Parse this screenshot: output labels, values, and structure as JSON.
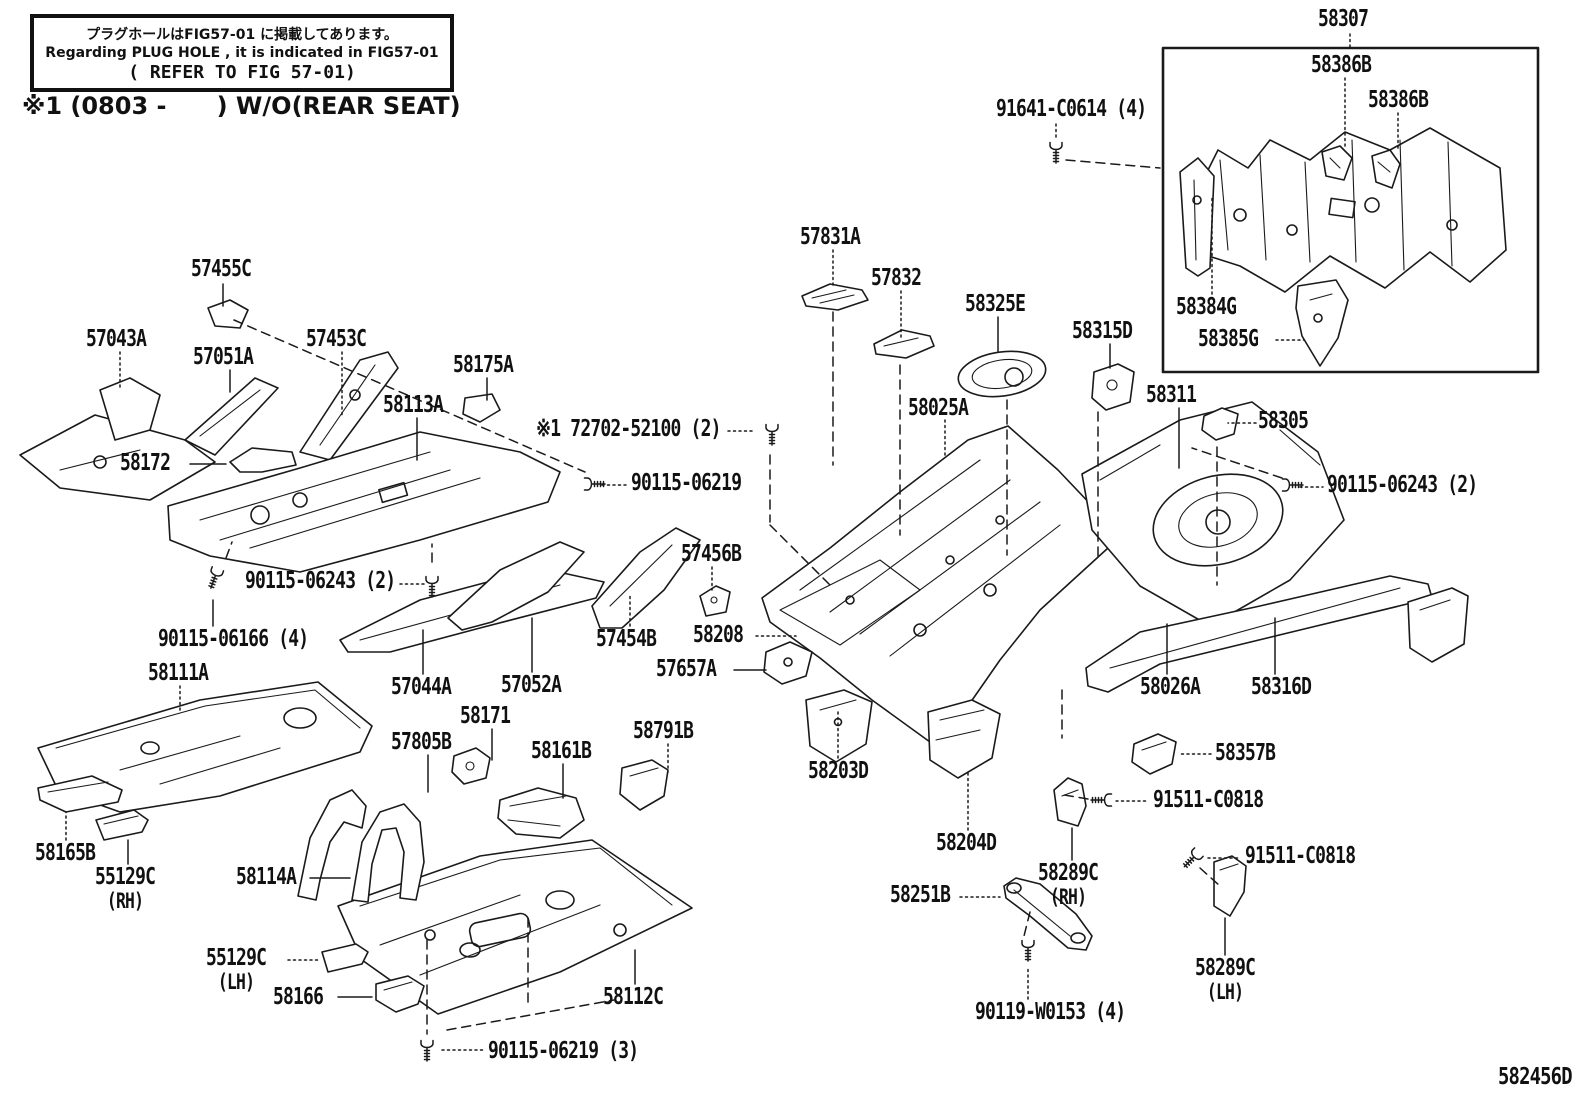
{
  "page": {
    "background": "#ffffff",
    "line_color": "#1a1a1a"
  },
  "note_box": {
    "line1": "プラグホールはFIG57-01 に掲載してあります。",
    "line2": "Regarding PLUG HOLE , it is indicated in FIG57-01",
    "line3": "( REFER TO FIG 57-01)"
  },
  "footnote": "※1 (0803 -      ) W/O(REAR SEAT)",
  "figure_code": "582456D",
  "diagram": {
    "labels": [
      {
        "text": "58307",
        "x": 1318,
        "y": 8,
        "leaders": [
          [
            1350,
            34,
            1350,
            47,
            "dotted"
          ]
        ]
      },
      {
        "text": "58386B",
        "x": 1311,
        "y": 54,
        "leaders": [
          [
            1345,
            78,
            1345,
            146,
            "dotted"
          ]
        ]
      },
      {
        "text": "58386B",
        "x": 1368,
        "y": 89,
        "leaders": [
          [
            1398,
            113,
            1398,
            150,
            "dotted"
          ]
        ]
      },
      {
        "text": "91641-C0614 (4)",
        "x": 996,
        "y": 98,
        "leaders": [
          [
            1056,
            124,
            1056,
            138,
            "dotted"
          ]
        ]
      },
      {
        "text": "58384G",
        "x": 1176,
        "y": 296,
        "leaders": [
          [
            1212,
            294,
            1212,
            198,
            "dotted"
          ]
        ]
      },
      {
        "text": "58385G",
        "x": 1198,
        "y": 328,
        "leaders": [
          [
            1276,
            340,
            1304,
            340,
            "dotted"
          ]
        ]
      },
      {
        "text": "57455C",
        "x": 191,
        "y": 258,
        "leaders": [
          [
            223,
            284,
            223,
            306,
            "solid"
          ]
        ]
      },
      {
        "text": "57043A",
        "x": 86,
        "y": 328,
        "leaders": [
          [
            120,
            352,
            120,
            388,
            "dotted"
          ]
        ]
      },
      {
        "text": "57051A",
        "x": 193,
        "y": 346,
        "leaders": [
          [
            230,
            370,
            230,
            392,
            "solid"
          ]
        ]
      },
      {
        "text": "57453C",
        "x": 306,
        "y": 328,
        "leaders": [
          [
            342,
            352,
            342,
            415,
            "dotted"
          ]
        ]
      },
      {
        "text": "58175A",
        "x": 453,
        "y": 354,
        "leaders": [
          [
            487,
            378,
            487,
            400,
            "solid"
          ]
        ]
      },
      {
        "text": "58113A",
        "x": 383,
        "y": 394,
        "leaders": [
          [
            417,
            418,
            417,
            460,
            "solid"
          ]
        ]
      },
      {
        "text": "58172",
        "x": 120,
        "y": 452,
        "leaders": [
          [
            190,
            464,
            226,
            464,
            "solid"
          ]
        ]
      },
      {
        "text": "※1 72702-52100 (2)",
        "x": 536,
        "y": 418,
        "leaders": [
          [
            728,
            431,
            752,
            431,
            "dotted"
          ]
        ]
      },
      {
        "text": "90115-06219",
        "x": 631,
        "y": 472,
        "leaders": [
          [
            602,
            485,
            627,
            485,
            "dotted"
          ]
        ]
      },
      {
        "text": "58025A",
        "x": 908,
        "y": 397,
        "leaders": [
          [
            945,
            420,
            945,
            458,
            "dotted"
          ]
        ]
      },
      {
        "text": "57831A",
        "x": 800,
        "y": 226,
        "leaders": [
          [
            833,
            250,
            833,
            286,
            "dotted"
          ]
        ]
      },
      {
        "text": "57832",
        "x": 871,
        "y": 267,
        "leaders": [
          [
            901,
            291,
            901,
            340,
            "dotted"
          ]
        ]
      },
      {
        "text": "58325E",
        "x": 965,
        "y": 293,
        "leaders": [
          [
            998,
            317,
            998,
            352,
            "solid"
          ]
        ]
      },
      {
        "text": "58315D",
        "x": 1072,
        "y": 320,
        "leaders": [
          [
            1110,
            344,
            1110,
            368,
            "solid"
          ]
        ]
      },
      {
        "text": "58311",
        "x": 1146,
        "y": 384,
        "leaders": [
          [
            1179,
            408,
            1179,
            468,
            "solid"
          ]
        ]
      },
      {
        "text": "58305",
        "x": 1258,
        "y": 410,
        "leaders": [
          [
            1256,
            423,
            1228,
            423,
            "dotted"
          ]
        ]
      },
      {
        "text": "90115-06243 (2)",
        "x": 1327,
        "y": 474,
        "leaders": [
          [
            1300,
            487,
            1323,
            487,
            "dotted"
          ]
        ]
      },
      {
        "text": "90115-06243 (2)",
        "x": 245,
        "y": 570,
        "leaders": [
          [
            400,
            584,
            424,
            584,
            "dotted"
          ]
        ]
      },
      {
        "text": "90115-06166 (4)",
        "x": 158,
        "y": 628,
        "leaders": [
          [
            213,
            626,
            213,
            600,
            "solid"
          ]
        ]
      },
      {
        "text": "57456B",
        "x": 681,
        "y": 543,
        "leaders": [
          [
            712,
            567,
            712,
            590,
            "dotted"
          ]
        ]
      },
      {
        "text": "57454B",
        "x": 596,
        "y": 628,
        "leaders": [
          [
            630,
            626,
            630,
            594,
            "dotted"
          ]
        ]
      },
      {
        "text": "58208",
        "x": 693,
        "y": 624,
        "leaders": [
          [
            756,
            636,
            796,
            636,
            "dotted"
          ]
        ]
      },
      {
        "text": "57657A",
        "x": 656,
        "y": 658,
        "leaders": [
          [
            734,
            670,
            766,
            670,
            "solid"
          ]
        ]
      },
      {
        "text": "58111A",
        "x": 148,
        "y": 662,
        "leaders": [
          [
            180,
            686,
            180,
            712,
            "dotted"
          ]
        ]
      },
      {
        "text": "57044A",
        "x": 391,
        "y": 676,
        "leaders": [
          [
            423,
            674,
            423,
            630,
            "solid"
          ]
        ]
      },
      {
        "text": "57052A",
        "x": 501,
        "y": 674,
        "leaders": [
          [
            532,
            672,
            532,
            618,
            "solid"
          ]
        ]
      },
      {
        "text": "58171",
        "x": 460,
        "y": 705,
        "leaders": [
          [
            492,
            729,
            492,
            760,
            "solid"
          ]
        ]
      },
      {
        "text": "57805B",
        "x": 391,
        "y": 731,
        "leaders": [
          [
            428,
            755,
            428,
            792,
            "solid"
          ]
        ]
      },
      {
        "text": "58161B",
        "x": 531,
        "y": 740,
        "leaders": [
          [
            563,
            764,
            563,
            798,
            "solid"
          ]
        ]
      },
      {
        "text": "58791B",
        "x": 633,
        "y": 720,
        "leaders": [
          [
            668,
            744,
            668,
            772,
            "dotted"
          ]
        ]
      },
      {
        "text": "58203D",
        "x": 808,
        "y": 760,
        "leaders": [
          [
            838,
            758,
            838,
            712,
            "dotted"
          ]
        ]
      },
      {
        "text": "58204D",
        "x": 936,
        "y": 832,
        "leaders": [
          [
            968,
            830,
            968,
            772,
            "dotted"
          ]
        ]
      },
      {
        "text": "58026A",
        "x": 1140,
        "y": 676,
        "leaders": [
          [
            1167,
            674,
            1167,
            624,
            "solid"
          ]
        ]
      },
      {
        "text": "58316D",
        "x": 1251,
        "y": 676,
        "leaders": [
          [
            1275,
            674,
            1275,
            618,
            "solid"
          ]
        ]
      },
      {
        "text": "58357B",
        "x": 1215,
        "y": 742,
        "leaders": [
          [
            1211,
            754,
            1180,
            754,
            "dotted"
          ]
        ]
      },
      {
        "text": "91511-C0818",
        "x": 1153,
        "y": 789,
        "leaders": [
          [
            1116,
            801,
            1149,
            801,
            "dotted"
          ]
        ]
      },
      {
        "text": "58289C",
        "x": 1038,
        "y": 862,
        "sub": "(RH)",
        "leaders": [
          [
            1072,
            860,
            1072,
            828,
            "solid"
          ]
        ]
      },
      {
        "text": "58251B",
        "x": 890,
        "y": 884,
        "leaders": [
          [
            960,
            897,
            1000,
            897,
            "dotted"
          ]
        ]
      },
      {
        "text": "91511-C0818",
        "x": 1245,
        "y": 845,
        "leaders": [
          [
            1208,
            858,
            1241,
            858,
            "dotted"
          ]
        ]
      },
      {
        "text": "58289C",
        "x": 1195,
        "y": 957,
        "sub": "(LH)",
        "leaders": [
          [
            1225,
            955,
            1225,
            918,
            "solid"
          ]
        ]
      },
      {
        "text": "90119-W0153 (4)",
        "x": 975,
        "y": 1001,
        "leaders": [
          [
            1028,
            999,
            1028,
            966,
            "dotted"
          ]
        ]
      },
      {
        "text": "58165B",
        "x": 35,
        "y": 842,
        "leaders": [
          [
            66,
            840,
            66,
            812,
            "dotted"
          ]
        ]
      },
      {
        "text": "55129C",
        "x": 95,
        "y": 866,
        "sub": "(RH)",
        "leaders": [
          [
            128,
            864,
            128,
            840,
            "solid"
          ]
        ]
      },
      {
        "text": "58114A",
        "x": 236,
        "y": 866,
        "leaders": [
          [
            310,
            878,
            350,
            878,
            "solid"
          ]
        ]
      },
      {
        "text": "55129C",
        "x": 206,
        "y": 947,
        "sub": "(LH)",
        "leaders": [
          [
            288,
            960,
            318,
            960,
            "dotted"
          ]
        ]
      },
      {
        "text": "58166",
        "x": 273,
        "y": 986,
        "leaders": [
          [
            338,
            997,
            372,
            997,
            "solid"
          ]
        ]
      },
      {
        "text": "58112C",
        "x": 603,
        "y": 986,
        "leaders": [
          [
            635,
            984,
            635,
            950,
            "solid"
          ]
        ]
      },
      {
        "text": "90115-06219 (3)",
        "x": 488,
        "y": 1040,
        "leaders": [
          [
            442,
            1050,
            484,
            1050,
            "dotted"
          ]
        ]
      }
    ],
    "bolts": [
      {
        "x": 1056,
        "y": 148,
        "a": 0
      },
      {
        "x": 772,
        "y": 430,
        "a": 0
      },
      {
        "x": 590,
        "y": 484,
        "a": -90
      },
      {
        "x": 432,
        "y": 582,
        "a": 0
      },
      {
        "x": 216,
        "y": 574,
        "a": 20
      },
      {
        "x": 1288,
        "y": 485,
        "a": -90
      },
      {
        "x": 1106,
        "y": 800,
        "a": 90
      },
      {
        "x": 1195,
        "y": 856,
        "a": 45
      },
      {
        "x": 1028,
        "y": 946,
        "a": 0
      },
      {
        "x": 427,
        "y": 1046,
        "a": 0
      }
    ],
    "dashes": [
      [
        234,
        320,
        585,
        472
      ],
      [
        770,
        455,
        770,
        522
      ],
      [
        770,
        525,
        833,
        588
      ],
      [
        833,
        312,
        833,
        465
      ],
      [
        900,
        365,
        900,
        535
      ],
      [
        1007,
        400,
        1007,
        555
      ],
      [
        1098,
        412,
        1098,
        558
      ],
      [
        1217,
        447,
        1217,
        585
      ],
      [
        1282,
        478,
        1192,
        448
      ],
      [
        432,
        562,
        432,
        544
      ],
      [
        226,
        558,
        232,
        542
      ],
      [
        1062,
        690,
        1062,
        738
      ],
      [
        1088,
        799,
        1064,
        795
      ],
      [
        1200,
        868,
        1220,
        886
      ],
      [
        1030,
        912,
        1024,
        936
      ],
      [
        427,
        940,
        427,
        1034
      ],
      [
        528,
        918,
        528,
        1002
      ],
      [
        447,
        1030,
        614,
        1000
      ],
      [
        1066,
        160,
        1160,
        168
      ]
    ]
  }
}
